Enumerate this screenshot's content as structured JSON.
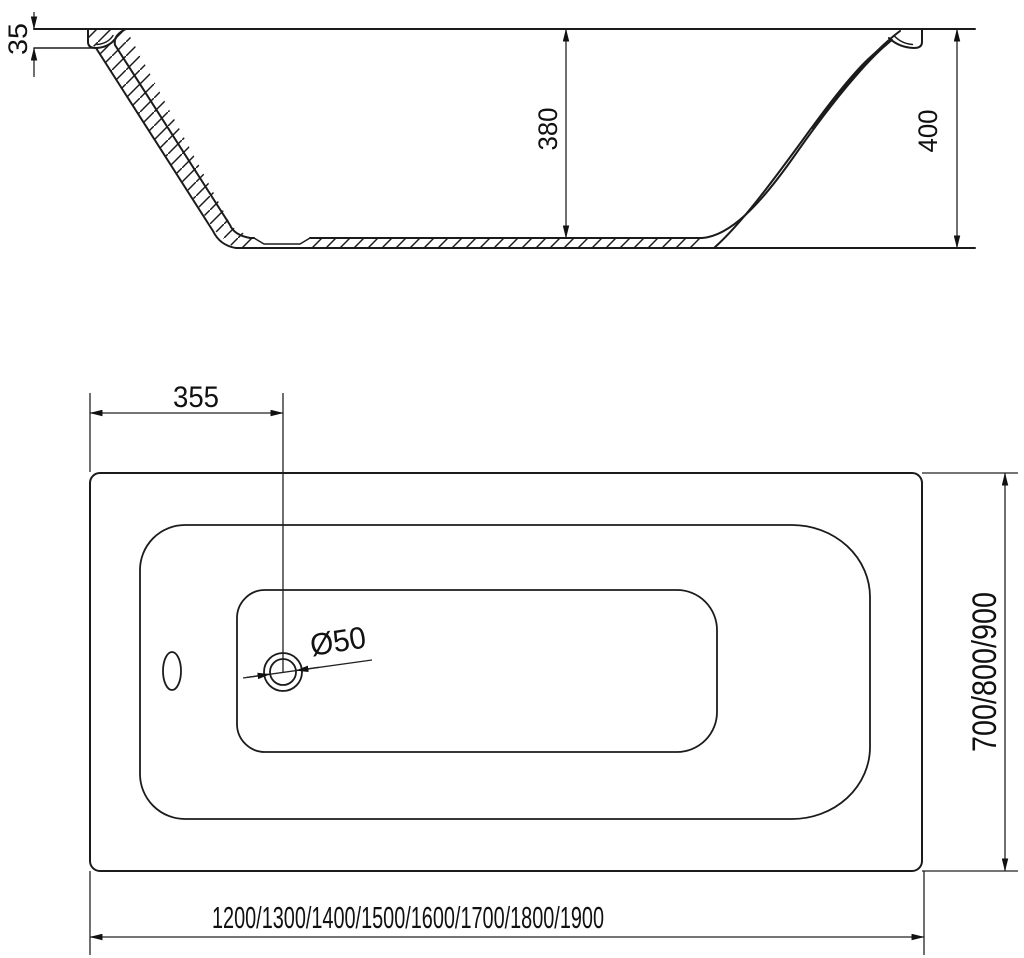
{
  "drawing": {
    "section_view": {
      "rim_thickness": "35",
      "inner_depth": "380",
      "total_height": "400"
    },
    "plan_view": {
      "drain_offset": "355",
      "drain_diameter": "Ø50",
      "length_options": "1200/1300/1400/1500/1600/1700/1800/1900",
      "width_options": "700/800/900"
    }
  }
}
